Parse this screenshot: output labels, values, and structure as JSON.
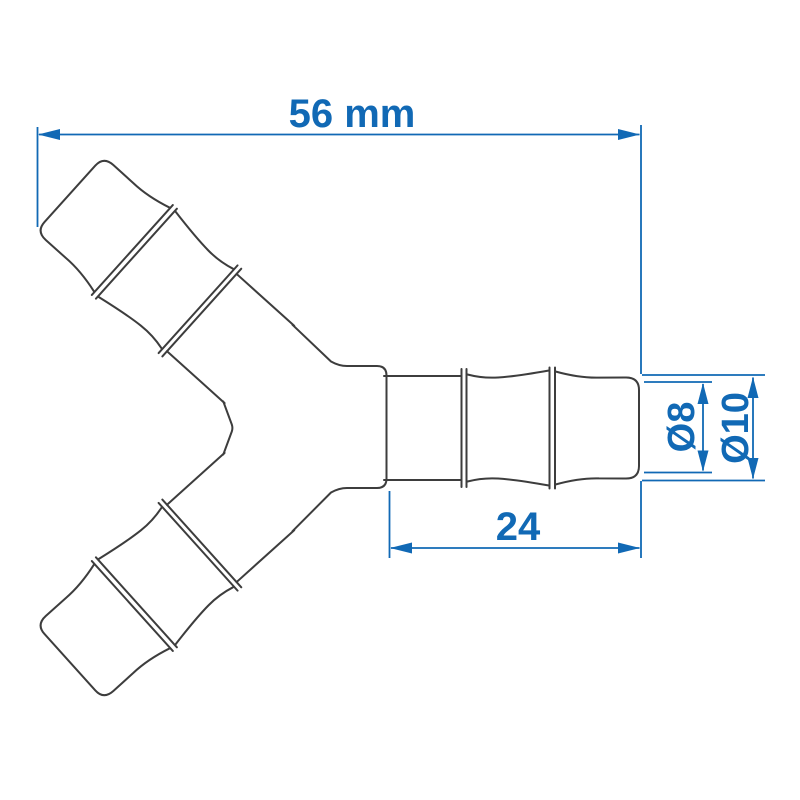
{
  "drawing": {
    "title": "Y hose connector technical drawing",
    "part_name": "y-piece-hose-connector",
    "view": "2D outline with dimension annotations"
  },
  "dimensions": {
    "overall_width_label": "56 mm",
    "branch_length_label": "24",
    "inner_diameter_label": "Ø8",
    "outer_diameter_label": "Ø10"
  },
  "colors": {
    "dimension": "#1169b5",
    "outline": "#3d3d3d",
    "background": "#ffffff"
  }
}
